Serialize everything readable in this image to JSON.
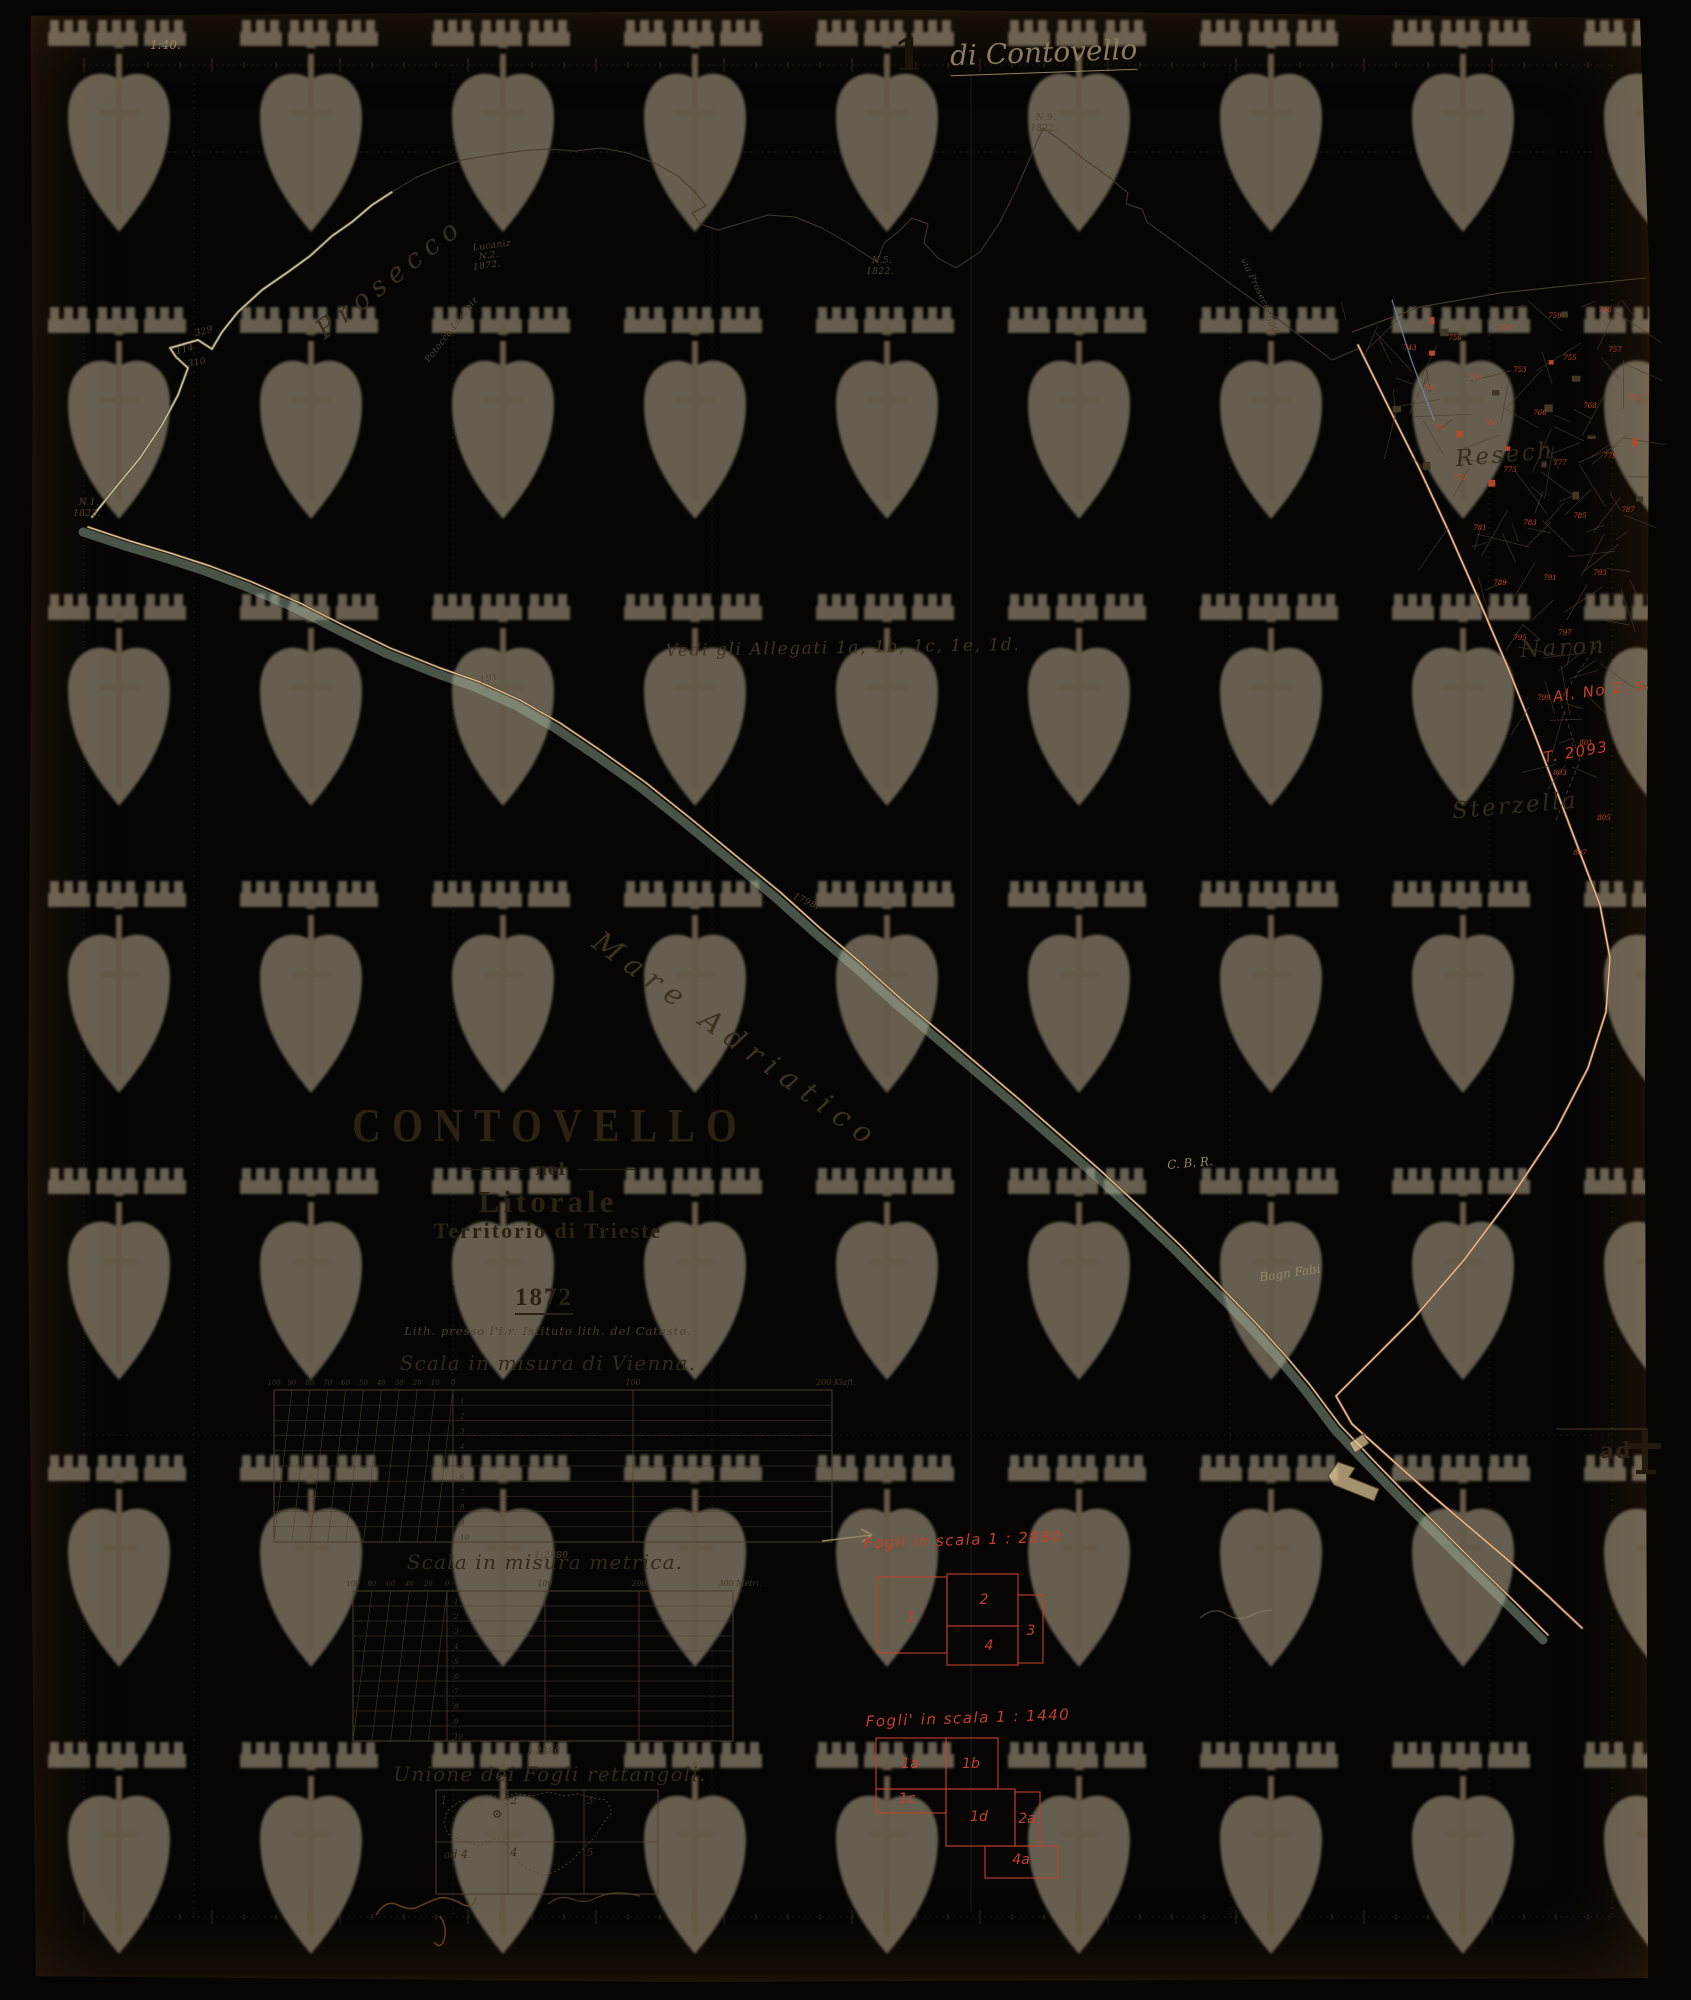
{
  "header": {
    "sheet_number": "1",
    "sheet_annotation": "di Contovello",
    "corner_note": "1:40."
  },
  "title_block": {
    "name": "CONTOVELLO",
    "connector": "nel",
    "region": "Litorale",
    "territory": "Territorio di Trieste",
    "year": "1872",
    "imprint": "Lith. presso l'i.r. Istituto lith. del Catasto."
  },
  "edge_mark": {
    "text": "ad",
    "symbol": "dagger-4-mark"
  },
  "scales": {
    "vienna": {
      "title": "Scala in misura di Vienna.",
      "title_x": 548,
      "title_y": 1363,
      "ratio": "1:2880.",
      "ratio_x": 553,
      "ratio_y": 1556,
      "box": {
        "x": 274,
        "y": 1390,
        "w": 558,
        "h": 152
      },
      "diag_end": 453,
      "dividers": [
        453,
        633
      ],
      "left_labels": [
        "100",
        "90",
        "80",
        "70",
        "60",
        "50",
        "40",
        "30",
        "20",
        "10",
        "0"
      ],
      "right_labels": [
        {
          "t": "100",
          "x": 633
        },
        {
          "t": "200 Klaft.",
          "x": 836
        }
      ],
      "rows": [
        "1",
        "2",
        "3",
        "4",
        "5",
        "6",
        "7",
        "8",
        "9",
        "10"
      ]
    },
    "metrica": {
      "title": "Scala in misura metrica.",
      "title_x": 545,
      "title_y": 1562,
      "ratio": "1:2880.",
      "ratio_x": 545,
      "ratio_y": 1752,
      "box": {
        "x": 353,
        "y": 1591,
        "w": 380,
        "h": 150
      },
      "diag_end": 447,
      "dividers": [
        447,
        545,
        639
      ],
      "left_labels": [
        "100",
        "80",
        "60",
        "40",
        "20",
        "0"
      ],
      "right_labels": [
        {
          "t": "100",
          "x": 545
        },
        {
          "t": "200",
          "x": 639
        },
        {
          "t": "300 Metri.",
          "x": 740
        }
      ],
      "rows": [
        "1",
        "2",
        "3",
        "4",
        "5",
        "6",
        "7",
        "8",
        "9",
        "10"
      ]
    }
  },
  "index_map": {
    "title": "Unione dei Fogli rettangoli.",
    "title_x": 550,
    "title_y": 1774,
    "box": {
      "x": 436,
      "y": 1790,
      "w": 222,
      "h": 104
    },
    "col_lines": [
      508,
      584
    ],
    "row_line": 1842,
    "cells": [
      {
        "t": "1",
        "x": 444,
        "y": 1800
      },
      {
        "t": "2",
        "x": 514,
        "y": 1800
      },
      {
        "t": "3",
        "x": 590,
        "y": 1800
      },
      {
        "t": "ad 4",
        "x": 456,
        "y": 1854
      },
      {
        "t": "4",
        "x": 514,
        "y": 1852
      },
      {
        "t": "5",
        "x": 590,
        "y": 1852
      }
    ]
  },
  "fogli_red": [
    {
      "label": "Fogli in scala 1 : 2880",
      "label_x": 963,
      "label_y": 1540,
      "rects": [
        {
          "id": "1",
          "x": 877,
          "y": 1577,
          "w": 70,
          "h": 76,
          "lx": 911,
          "ly": 1622
        },
        {
          "id": "2",
          "x": 947,
          "y": 1574,
          "w": 71,
          "h": 52,
          "lx": 984,
          "ly": 1604
        },
        {
          "id": "4",
          "x": 947,
          "y": 1626,
          "w": 71,
          "h": 39,
          "lx": 989,
          "ly": 1650
        },
        {
          "id": "3",
          "x": 1018,
          "y": 1595,
          "w": 25,
          "h": 68,
          "lx": 1031,
          "ly": 1635
        }
      ]
    },
    {
      "label": "Fogli' in scala 1 : 1440",
      "label_x": 968,
      "label_y": 1718,
      "rects": [
        {
          "id": "1a",
          "x": 876,
          "y": 1738,
          "w": 70,
          "h": 51,
          "lx": 910,
          "ly": 1768
        },
        {
          "id": "1b",
          "x": 946,
          "y": 1738,
          "w": 52,
          "h": 51,
          "lx": 971,
          "ly": 1768
        },
        {
          "id": "1c",
          "x": 876,
          "y": 1789,
          "w": 70,
          "h": 24,
          "lx": 907,
          "ly": 1803
        },
        {
          "id": "1d",
          "x": 946,
          "y": 1789,
          "w": 69,
          "h": 57,
          "lx": 979,
          "ly": 1821
        },
        {
          "id": "2a",
          "x": 1015,
          "y": 1792,
          "w": 25,
          "h": 54,
          "lx": 1027,
          "ly": 1823
        },
        {
          "id": "4a",
          "x": 985,
          "y": 1846,
          "w": 73,
          "h": 32,
          "lx": 1021,
          "ly": 1864
        }
      ]
    }
  ],
  "map_labels": [
    {
      "t": "Prosecco",
      "x": 390,
      "y": 278,
      "r": -38,
      "cls": "terrbig"
    },
    {
      "t": "Potocco Lucaniz",
      "x": 452,
      "y": 330,
      "r": -52,
      "cls": "tinyit"
    },
    {
      "t": "Lucaniz",
      "x": 492,
      "y": 246,
      "r": -8,
      "cls": "tinyit"
    },
    {
      "t": "N.2.",
      "x": 489,
      "y": 256,
      "r": -8,
      "cls": "tinyit"
    },
    {
      "t": "1872.",
      "x": 487,
      "y": 266,
      "r": -8,
      "cls": "tinyit"
    },
    {
      "t": "N.5.",
      "x": 882,
      "y": 261,
      "r": 0,
      "cls": "tinyit"
    },
    {
      "t": "1822.",
      "x": 880,
      "y": 272,
      "r": 0,
      "cls": "tinyit"
    },
    {
      "t": "N.9.",
      "x": 1046,
      "y": 118,
      "r": 0,
      "cls": "tinyit"
    },
    {
      "t": "1822.",
      "x": 1044,
      "y": 129,
      "r": 0,
      "cls": "tinyit"
    },
    {
      "t": "N.1.",
      "x": 89,
      "y": 503,
      "r": 0,
      "cls": "tinyit"
    },
    {
      "t": "1822.",
      "x": 87,
      "y": 514,
      "r": 0,
      "cls": "tinyit"
    },
    {
      "t": "329",
      "x": 204,
      "y": 332,
      "r": -15,
      "cls": "tinyit"
    },
    {
      "t": "114",
      "x": 185,
      "y": 350,
      "r": -15,
      "cls": "tinyit"
    },
    {
      "t": "310",
      "x": 197,
      "y": 363,
      "r": -10,
      "cls": "tinyit"
    },
    {
      "t": "via Prosecco",
      "x": 1256,
      "y": 287,
      "r": 64,
      "cls": "tinyit"
    },
    {
      "t": "600.",
      "x": 1272,
      "y": 326,
      "r": 64,
      "cls": "tinyit"
    },
    {
      "t": "Vedi gli Allegati 1a, 1b, 1c, 1e, 1d.",
      "x": 843,
      "y": 648,
      "r": -1,
      "cls": "script17"
    },
    {
      "t": "191",
      "x": 489,
      "y": 679,
      "r": -10,
      "cls": "tinyit"
    },
    {
      "t": "1798.",
      "x": 806,
      "y": 902,
      "r": 25,
      "cls": "tinyit"
    },
    {
      "t": "Mare Adriatico",
      "x": 737,
      "y": 1040,
      "r": 36,
      "cls": "sealbl"
    },
    {
      "t": "Resech",
      "x": 1505,
      "y": 455,
      "r": -5,
      "cls": "terr2"
    },
    {
      "t": "Naron",
      "x": 1563,
      "y": 648,
      "r": -3,
      "cls": "terr2"
    },
    {
      "t": "Sterzella",
      "x": 1515,
      "y": 806,
      "r": -5,
      "cls": "terr2"
    },
    {
      "t": "Al. No 2. s.",
      "x": 1602,
      "y": 690,
      "r": -8,
      "cls": "redhand s11"
    },
    {
      "t": "T. 2093",
      "x": 1576,
      "y": 752,
      "r": -10,
      "cls": "redhand s12"
    },
    {
      "t": "C. B. R.",
      "x": 1190,
      "y": 1163,
      "r": -5,
      "cls": "pencil"
    },
    {
      "t": "Bagn Fabi",
      "x": 1290,
      "y": 1273,
      "r": -8,
      "cls": "pencil"
    }
  ],
  "parcel_numbers": [
    {
      "t": "743",
      "x": 1410,
      "y": 350
    },
    {
      "t": "756",
      "x": 1455,
      "y": 340
    },
    {
      "t": "758",
      "x": 1505,
      "y": 330
    },
    {
      "t": "759",
      "x": 1555,
      "y": 318
    },
    {
      "t": "760",
      "x": 1605,
      "y": 312
    },
    {
      "t": "748",
      "x": 1430,
      "y": 390
    },
    {
      "t": "750",
      "x": 1475,
      "y": 380
    },
    {
      "t": "753",
      "x": 1520,
      "y": 372
    },
    {
      "t": "755",
      "x": 1570,
      "y": 360
    },
    {
      "t": "757",
      "x": 1615,
      "y": 352
    },
    {
      "t": "762",
      "x": 1440,
      "y": 430
    },
    {
      "t": "764",
      "x": 1490,
      "y": 425
    },
    {
      "t": "766",
      "x": 1540,
      "y": 415
    },
    {
      "t": "768",
      "x": 1590,
      "y": 408
    },
    {
      "t": "770",
      "x": 1633,
      "y": 400
    },
    {
      "t": "772",
      "x": 1460,
      "y": 480
    },
    {
      "t": "775",
      "x": 1510,
      "y": 472
    },
    {
      "t": "777",
      "x": 1560,
      "y": 465
    },
    {
      "t": "779",
      "x": 1610,
      "y": 458
    },
    {
      "t": "781",
      "x": 1480,
      "y": 530
    },
    {
      "t": "783",
      "x": 1530,
      "y": 525
    },
    {
      "t": "785",
      "x": 1580,
      "y": 518
    },
    {
      "t": "787",
      "x": 1628,
      "y": 512
    },
    {
      "t": "789",
      "x": 1500,
      "y": 585
    },
    {
      "t": "791",
      "x": 1550,
      "y": 580
    },
    {
      "t": "793",
      "x": 1600,
      "y": 575
    },
    {
      "t": "795",
      "x": 1520,
      "y": 640
    },
    {
      "t": "797",
      "x": 1565,
      "y": 635
    },
    {
      "t": "799",
      "x": 1544,
      "y": 700
    },
    {
      "t": "801",
      "x": 1586,
      "y": 745
    },
    {
      "t": "803",
      "x": 1560,
      "y": 775
    },
    {
      "t": "805",
      "x": 1604,
      "y": 820
    },
    {
      "t": "807",
      "x": 1580,
      "y": 855
    }
  ],
  "colors": {
    "paper": "#e6c592",
    "ink": "#4c3e2c",
    "red_annotation": "#c2402c",
    "pencil": "#97856a",
    "sea_tint": "#9db39b",
    "road_tint": "#8a5a45",
    "background": "#060504"
  },
  "watermark": {
    "motif": "trieste-shield-with-halberd-and-battlement",
    "cols": 9,
    "rows": 7
  }
}
